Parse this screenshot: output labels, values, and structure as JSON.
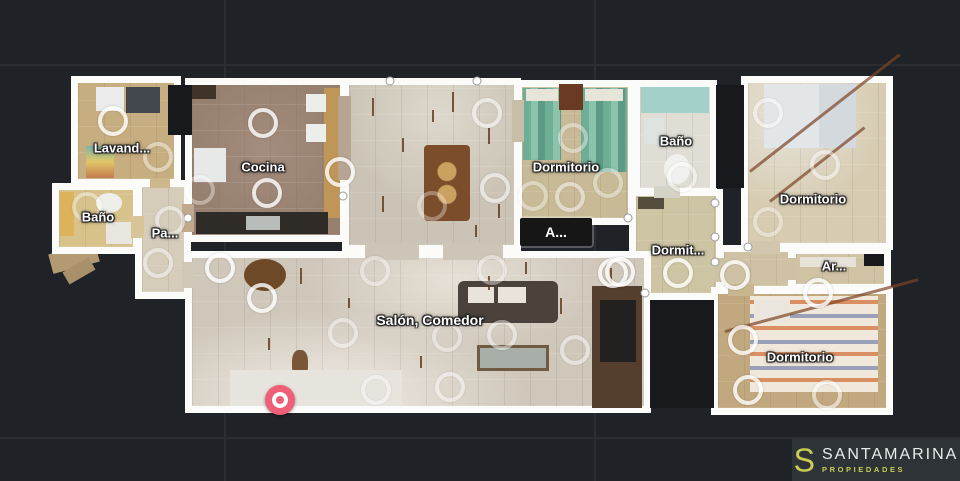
{
  "app": {
    "background_color": "#1f2226",
    "grid_line_color": "#2a2d32",
    "view": "floorplan-top-view"
  },
  "branding": {
    "logo_s": "S",
    "name": "SANTAMARINA",
    "tagline": "PROPIEDADES",
    "name_color": "#e9ebeb",
    "accent_color": "#c9cd52",
    "panel_color": "#2e3337"
  },
  "floorplan": {
    "wall_color": "#fbfbfa",
    "ring_color": "#ffffff",
    "current_position_color": "#ef5f78",
    "current_position": {
      "x": 280,
      "y": 400
    },
    "rooms": [
      {
        "id": "lavanderia",
        "label": "Lavand..."
      },
      {
        "id": "bano-izquierda",
        "label": "Baño"
      },
      {
        "id": "pasillo",
        "label": "Pa..."
      },
      {
        "id": "cocina",
        "label": "Cocina"
      },
      {
        "id": "dormitorio-centro",
        "label": "Dormitorio"
      },
      {
        "id": "bano-superior",
        "label": "Baño"
      },
      {
        "id": "acceso",
        "label": "A..."
      },
      {
        "id": "dormitorio-pequeno",
        "label": "Dormit..."
      },
      {
        "id": "dormitorio-der-sup",
        "label": "Dormitorio"
      },
      {
        "id": "armario",
        "label": "Ar..."
      },
      {
        "id": "dormitorio-der-inf",
        "label": "Dormitorio"
      },
      {
        "id": "salon-comedor",
        "label": "Salón, Comedor"
      }
    ],
    "viewpoints": [
      {
        "x": 113,
        "y": 121
      },
      {
        "x": 158,
        "y": 157,
        "o": 0.55
      },
      {
        "x": 200,
        "y": 190,
        "o": 0.45
      },
      {
        "x": 263,
        "y": 123
      },
      {
        "x": 340,
        "y": 172
      },
      {
        "x": 267,
        "y": 193
      },
      {
        "x": 87,
        "y": 207,
        "o": 0.5
      },
      {
        "x": 170,
        "y": 221,
        "o": 0.6
      },
      {
        "x": 220,
        "y": 268
      },
      {
        "x": 158,
        "y": 263,
        "o": 0.6
      },
      {
        "x": 262,
        "y": 298
      },
      {
        "x": 343,
        "y": 333,
        "o": 0.55
      },
      {
        "x": 375,
        "y": 271,
        "o": 0.5
      },
      {
        "x": 447,
        "y": 337,
        "o": 0.5
      },
      {
        "x": 492,
        "y": 270,
        "o": 0.5
      },
      {
        "x": 502,
        "y": 335,
        "o": 0.6
      },
      {
        "x": 575,
        "y": 350,
        "o": 0.6
      },
      {
        "x": 450,
        "y": 387,
        "o": 0.6
      },
      {
        "x": 376,
        "y": 390,
        "o": 0.5
      },
      {
        "x": 613,
        "y": 273
      },
      {
        "x": 487,
        "y": 113,
        "o": 0.7
      },
      {
        "x": 495,
        "y": 188,
        "o": 0.7
      },
      {
        "x": 432,
        "y": 206,
        "o": 0.4
      },
      {
        "x": 573,
        "y": 138,
        "o": 0.5
      },
      {
        "x": 533,
        "y": 196,
        "o": 0.5
      },
      {
        "x": 570,
        "y": 197,
        "o": 0.6
      },
      {
        "x": 608,
        "y": 183,
        "o": 0.5
      },
      {
        "x": 682,
        "y": 177,
        "o": 0.6
      },
      {
        "x": 678,
        "y": 273
      },
      {
        "x": 620,
        "y": 272
      },
      {
        "x": 768,
        "y": 113,
        "o": 0.6
      },
      {
        "x": 825,
        "y": 165,
        "o": 0.6
      },
      {
        "x": 768,
        "y": 222,
        "o": 0.5
      },
      {
        "x": 735,
        "y": 275
      },
      {
        "x": 818,
        "y": 293
      },
      {
        "x": 743,
        "y": 340
      },
      {
        "x": 748,
        "y": 390
      },
      {
        "x": 827,
        "y": 395,
        "o": 0.7
      }
    ]
  }
}
